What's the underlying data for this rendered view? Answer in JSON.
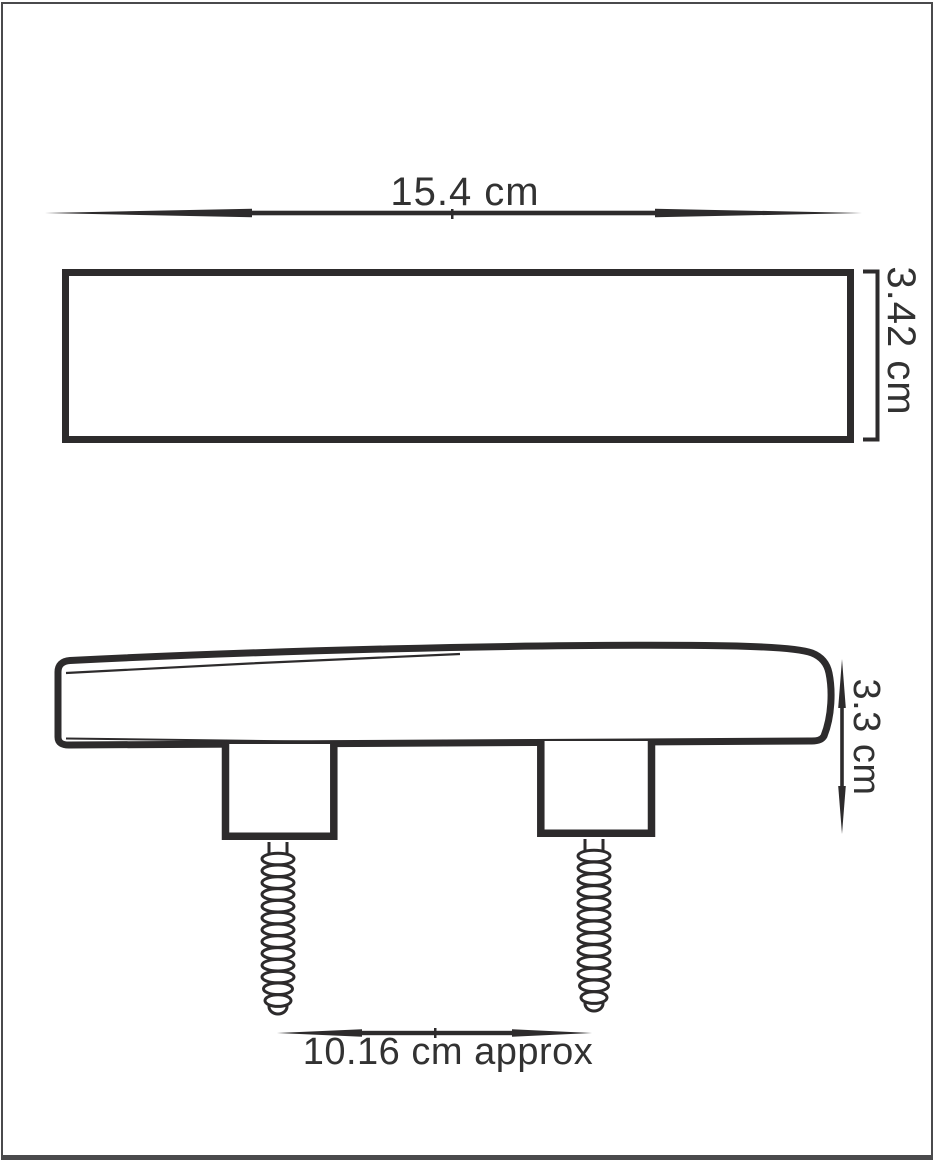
{
  "page": {
    "background": "#ffffff",
    "border_color": "#4a4a4c"
  },
  "drawing": {
    "line_color": "#2d2b2c",
    "text_color": "#323232",
    "top_view": {
      "width_label": "15.4 cm",
      "thickness_label": "3.42 cm"
    },
    "side_view": {
      "height_label": "3.3 cm",
      "stud_spacing_label": "10.16 cm approx",
      "stud_count": 2,
      "screw_count": 2
    }
  }
}
